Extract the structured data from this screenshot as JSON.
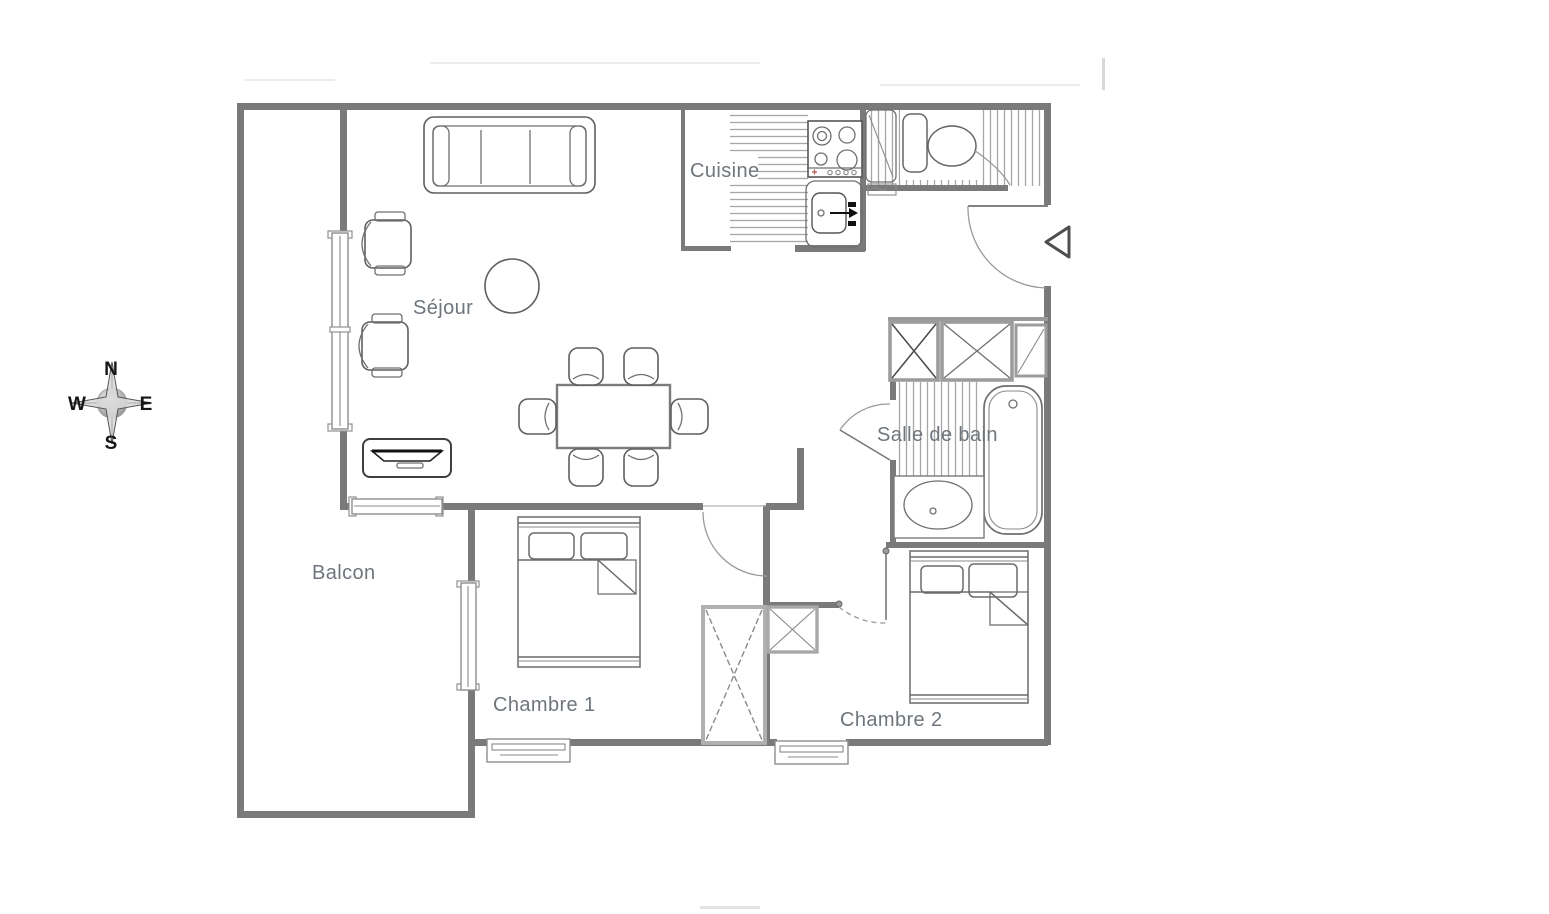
{
  "rooms": {
    "cuisine": {
      "label": "Cuisine"
    },
    "sejour": {
      "label": "Séjour"
    },
    "salle_de_bain": {
      "label": "Salle de bain"
    },
    "balcon": {
      "label": "Balcon"
    },
    "chambre_1": {
      "label": "Chambre 1"
    },
    "chambre_2": {
      "label": "Chambre 2"
    }
  },
  "compass": {
    "north": "N",
    "east": "E",
    "south": "S",
    "west": "W"
  },
  "icons": {
    "entrance_marker": "left-pointing-triangle",
    "compass_rose": "four-point-star",
    "sejour_furniture": [
      "sofa",
      "armchair",
      "armchair",
      "coffee-table",
      "tv-console",
      "dining-table",
      "dining-chair-x6"
    ],
    "cuisine_fixtures": [
      "kitchen-counter",
      "stove-4-burners",
      "kitchen-sink",
      "tall-cabinet",
      "toilet"
    ],
    "salle_de_bain_fixtures": [
      "storage-cabinet-x3",
      "bathtub",
      "washbasin"
    ],
    "chambre_1_fixtures": [
      "double-bed",
      "wardrobe"
    ],
    "chambre_2_fixtures": [
      "double-bed",
      "storage-box"
    ]
  },
  "colors": {
    "background": "#ffffff",
    "wall": "#7a7a7a",
    "room_label_text": "#6f757c",
    "furniture_outline": "#5f5f5f",
    "hatch": "#a6a6a6",
    "cabinet_outline": "#9c9c9c",
    "compass_text": "#161616"
  }
}
